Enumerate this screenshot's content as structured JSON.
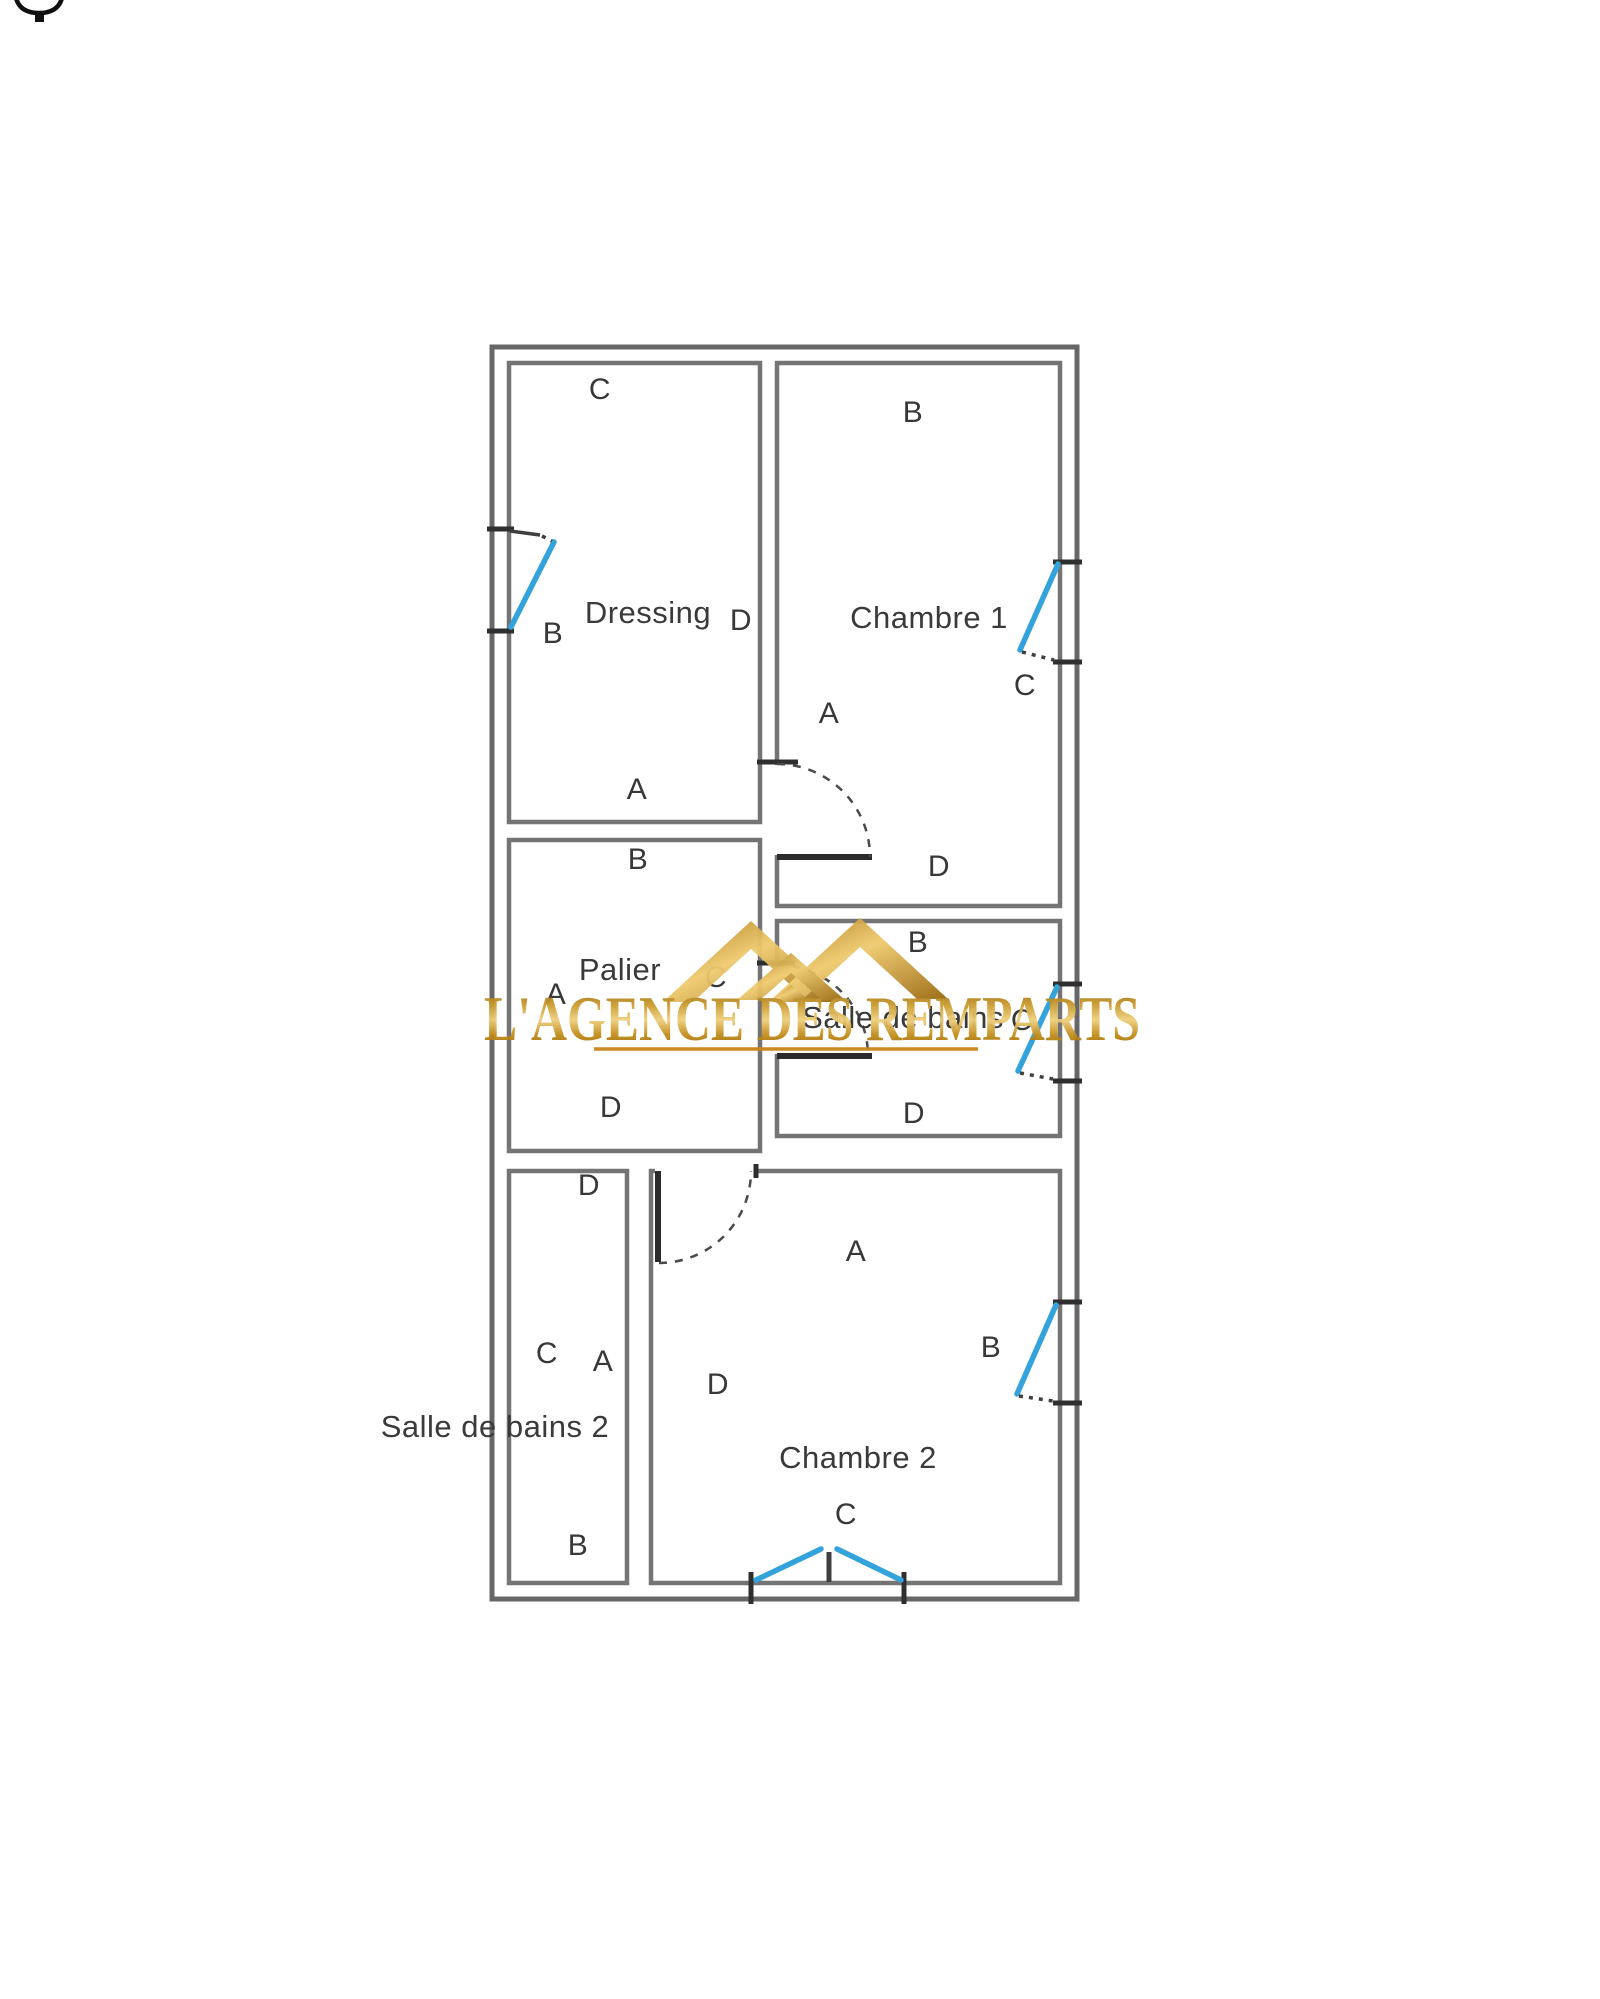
{
  "watermark": {
    "text": "L'AGENCE DES REMPARTS",
    "logo": "gold-roofs-logo",
    "gold_dark": "#8A5E0B",
    "gold_mid": "#C99A2E",
    "gold_light": "#EFCF7E",
    "underline_color": "#C8831B"
  },
  "icons": {
    "top_left": "cropped-oval-pin-icon"
  },
  "colors": {
    "wall": "#747474",
    "outer_wall": "#676767",
    "wall_break": "#2f2f2f",
    "door_leaf": "#2b2b2b",
    "window_blue": "#35A3DB",
    "label_text": "#383838",
    "background": "#ffffff"
  },
  "rooms": [
    {
      "name": "Dressing",
      "letters": {
        "top": "C",
        "right": "D",
        "bottom": "A",
        "left": "B"
      }
    },
    {
      "name": "Chambre 1",
      "letters": {
        "top": "B",
        "left": "A",
        "bottom": "D",
        "window_right": "C"
      }
    },
    {
      "name": "Palier",
      "letters": {
        "top": "B",
        "left": "A",
        "right": "C",
        "bottom": "D"
      }
    },
    {
      "name": "Salle de bains",
      "letters": {
        "top": "B",
        "bottom": "D",
        "window_right": "C"
      }
    },
    {
      "name": "Salle de bains 2",
      "letters": {
        "top": "D",
        "center_left": "C",
        "center_right": "A",
        "bottom": "B"
      }
    },
    {
      "name": "Chambre 2",
      "letters": {
        "top": "A",
        "upper_left": "D",
        "window_right": "B",
        "bottom": "C"
      }
    }
  ]
}
